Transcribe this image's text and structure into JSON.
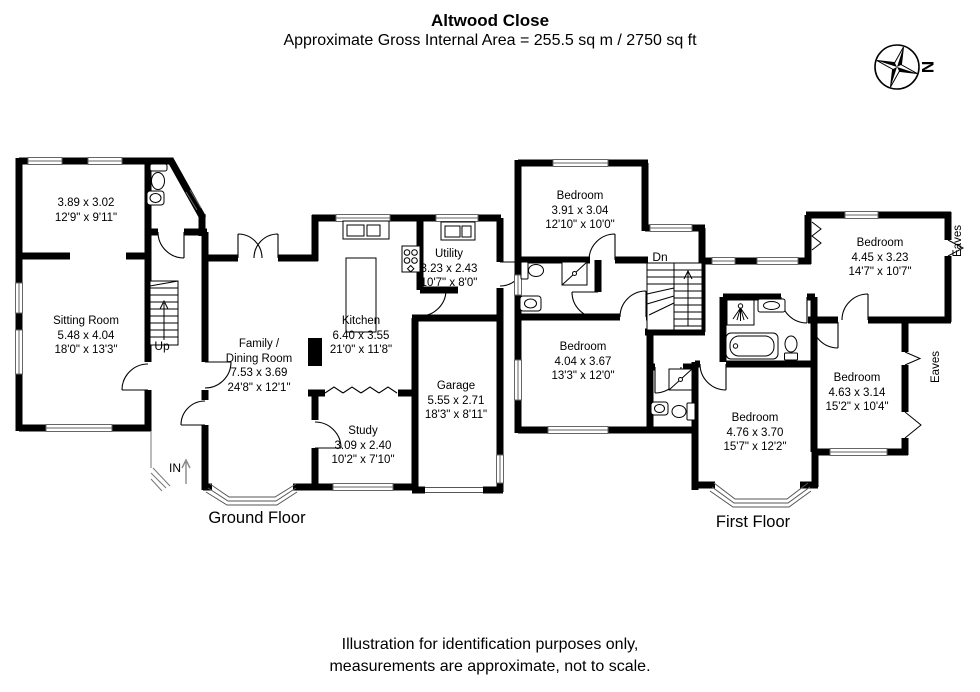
{
  "header": {
    "title": "Altwood Close",
    "subtitle": "Approximate Gross Internal Area = 255.5 sq m / 2750 sq ft"
  },
  "compass": {
    "north_label": "N"
  },
  "ground_floor": {
    "floor_label": "Ground Floor",
    "annotations": {
      "up": "Up",
      "entrance": "IN"
    },
    "rooms": [
      {
        "name": "",
        "metric": "3.89 x 3.02",
        "imperial": "12'9\" x 9'11\""
      },
      {
        "name": "Sitting Room",
        "metric": "5.48 x 4.04",
        "imperial": "18'0\" x 13'3\""
      },
      {
        "name": "Family /",
        "name2": "Dining Room",
        "metric": "7.53 x 3.69",
        "imperial": "24'8\" x 12'1\""
      },
      {
        "name": "Kitchen",
        "metric": "6.40 x 3.55",
        "imperial": "21'0\" x 11'8\""
      },
      {
        "name": "Utility",
        "metric": "3.23 x 2.43",
        "imperial": "10'7\" x 8'0\""
      },
      {
        "name": "Garage",
        "metric": "5.55 x 2.71",
        "imperial": "18'3\" x 8'11\""
      },
      {
        "name": "Study",
        "metric": "3.09 x 2.40",
        "imperial": "10'2\" x 7'10\""
      }
    ]
  },
  "first_floor": {
    "floor_label": "First Floor",
    "annotations": {
      "down": "Dn",
      "eaves": "Eaves"
    },
    "rooms": [
      {
        "name": "Bedroom",
        "metric": "3.91 x 3.04",
        "imperial": "12'10\" x 10'0\""
      },
      {
        "name": "Bedroom",
        "metric": "4.04 x 3.67",
        "imperial": "13'3\" x 12'0\""
      },
      {
        "name": "Bedroom",
        "metric": "4.45 x 3.23",
        "imperial": "14'7\" x 10'7\""
      },
      {
        "name": "Bedroom",
        "metric": "4.63 x 3.14",
        "imperial": "15'2\" x 10'4\""
      },
      {
        "name": "Bedroom",
        "metric": "4.76 x 3.70",
        "imperial": "15'7\" x 12'2\""
      }
    ]
  },
  "footer": {
    "line1": "Illustration for identification purposes only,",
    "line2": "measurements are approximate, not to scale."
  }
}
